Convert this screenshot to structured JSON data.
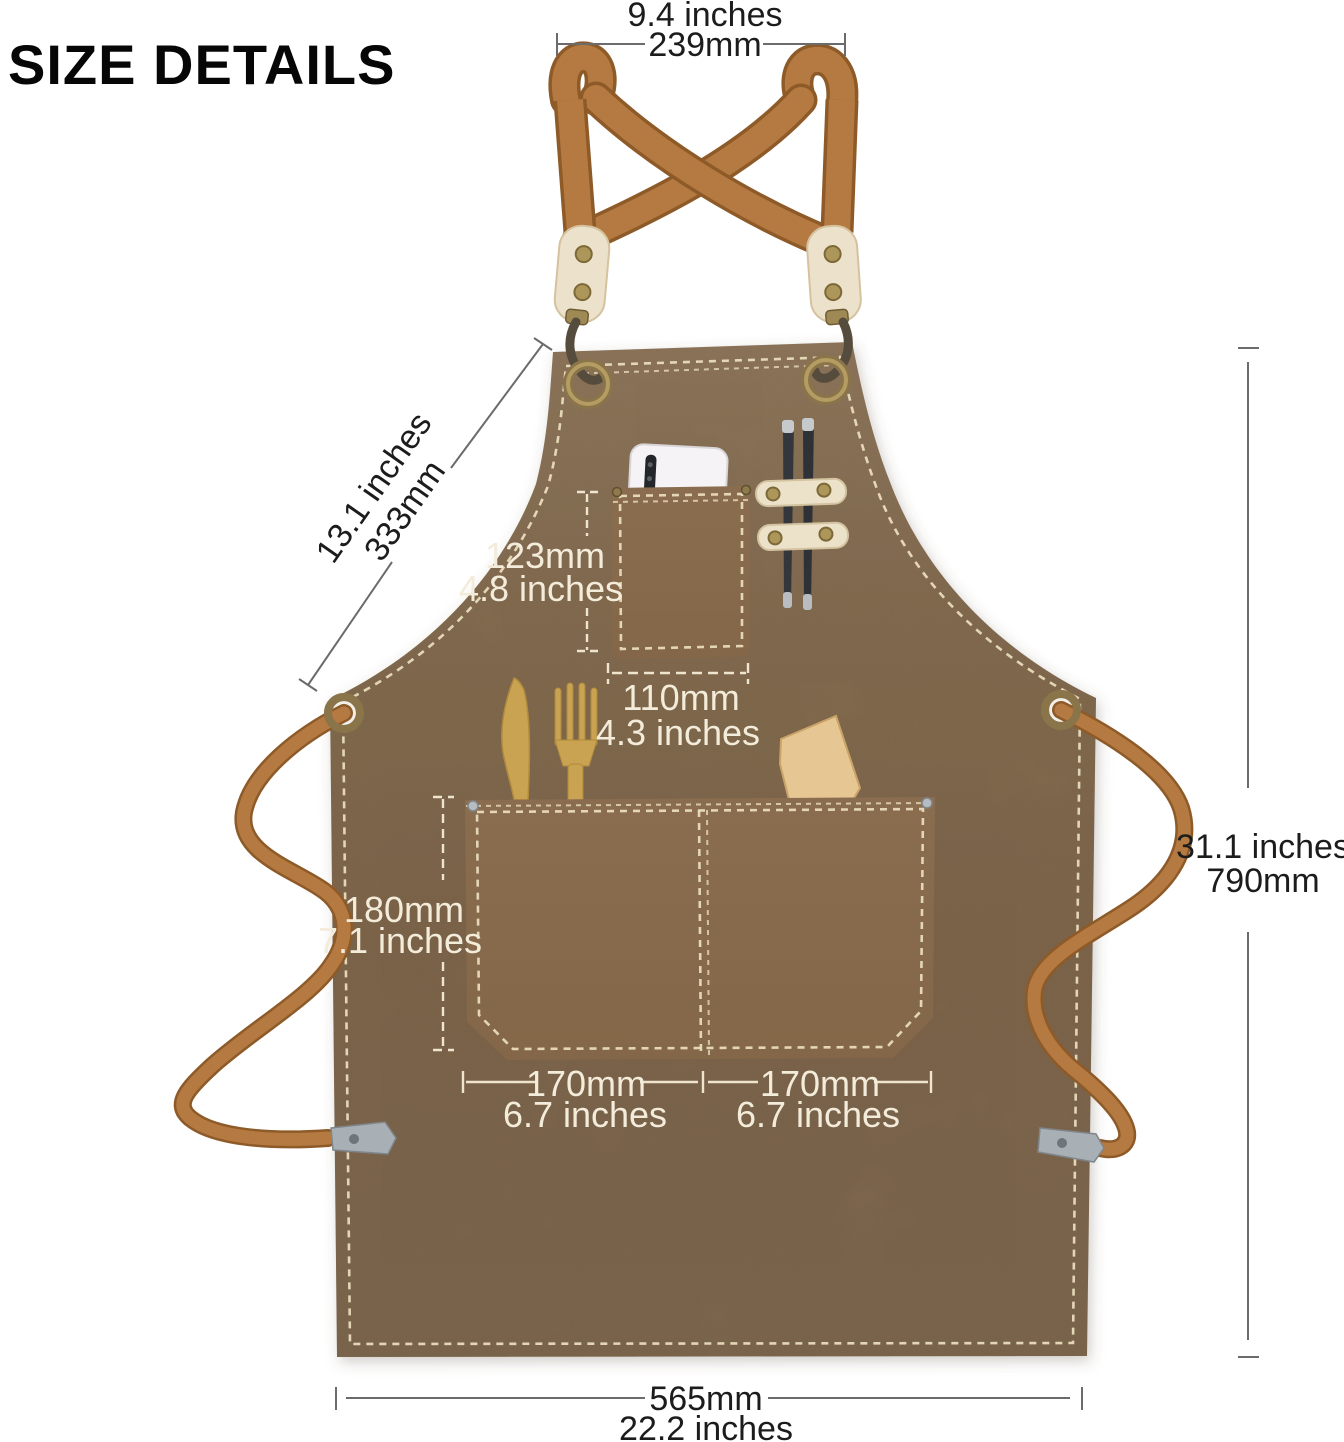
{
  "title": "SIZE DETAILS",
  "measurements": {
    "neck_strap": {
      "inches": "9.4 inches",
      "mm": "239mm"
    },
    "bib_side": {
      "inches": "13.1 inches",
      "mm": "333mm"
    },
    "chest_pocket_height": {
      "mm": "123mm",
      "inches": "4.8 inches"
    },
    "chest_pocket_width": {
      "mm": "110mm",
      "inches": "4.3 inches"
    },
    "front_pocket_height": {
      "mm": "180mm",
      "inches": "7.1 inches"
    },
    "front_pocket_left": {
      "mm": "170mm",
      "inches": "6.7 inches"
    },
    "front_pocket_right": {
      "mm": "170mm",
      "inches": "6.7 inches"
    },
    "apron_height": {
      "inches": "31.1 inches",
      "mm": "790mm"
    },
    "apron_width": {
      "mm": "565mm",
      "inches": "22.2 inches"
    }
  },
  "colors": {
    "canvas": "#8d7356",
    "strap_webbing": "#b47a42",
    "leather_tab": "#ece2cb",
    "stitching": "#e9dcbc",
    "annotation_dark": "#1c1c1c",
    "annotation_light": "#f4ecda",
    "brass": "#9f8a55",
    "metal_tip": "#a9b0b5"
  }
}
